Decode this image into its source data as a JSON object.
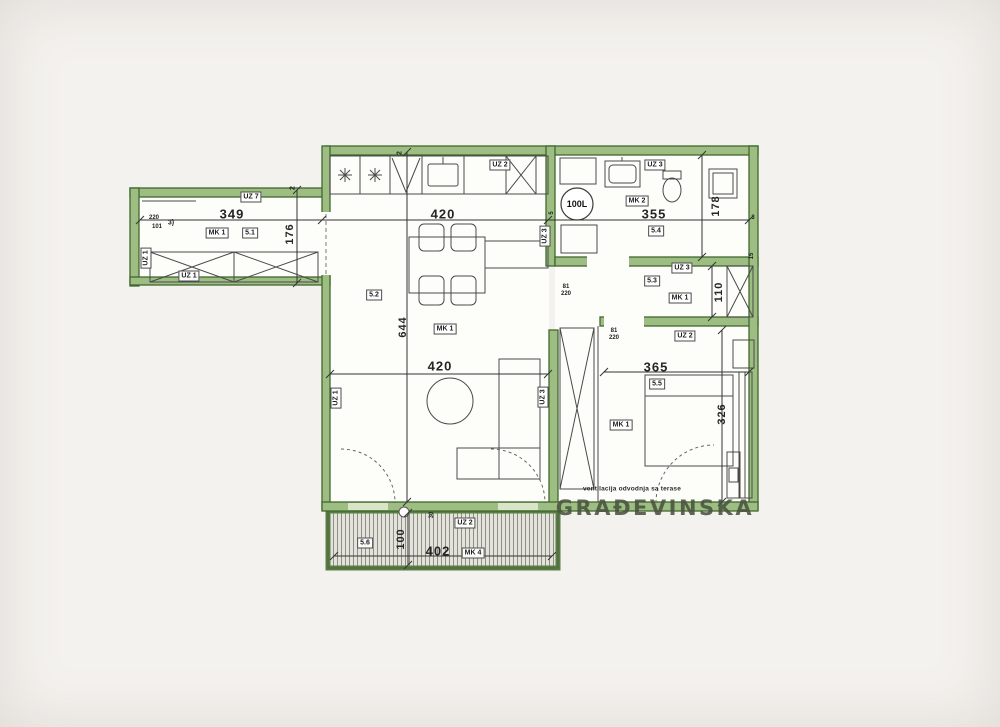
{
  "plan": {
    "watermark": "GRAĐEVINSKA",
    "note": "ventilacija odvodnja sa terase",
    "boiler": "100L",
    "dims": {
      "hall_w": "349",
      "hall_h": "176",
      "hall_a": "220",
      "hall_b": "101",
      "hall_mark": "3)",
      "kitchen_w": "420",
      "living_w": "420",
      "living_h": "644",
      "bath_w": "355",
      "bath_h": "178",
      "closet_h": "110",
      "bed_w": "365",
      "bed_h": "326",
      "terrace_w": "402",
      "terrace_h": "100",
      "terrace_t": "30",
      "wall_a": "2",
      "wall_b": "2",
      "wall_c": "5",
      "wall_d": "3",
      "wall_e": "15",
      "door1_w": "81",
      "door1_h": "220",
      "door2_w": "81",
      "door2_h": "220"
    },
    "tags": {
      "uz7": "UZ 7",
      "uz1_wall": "UZ 1",
      "uz1_hall": "UZ 1",
      "mk1_hall": "MK 1",
      "s1": "5.1",
      "uz2_kitchen": "UZ 2",
      "uz3_kitchen": "UZ 3",
      "s2": "5.2",
      "mk1_living": "MK 1",
      "uz1_living": "UZ 1",
      "uz3_living": "UZ 3",
      "uz3_bath": "UZ 3",
      "mk2": "MK 2",
      "s4": "5.4",
      "uz3_closet": "UZ 3",
      "s3": "5.3",
      "mk1_closet": "MK 1",
      "uz2_bed": "UZ 2",
      "s5": "5.5",
      "mk1_bed": "MK 1",
      "s6": "5.6",
      "uz2_terrace": "UZ 2",
      "mk4": "MK 4"
    }
  }
}
